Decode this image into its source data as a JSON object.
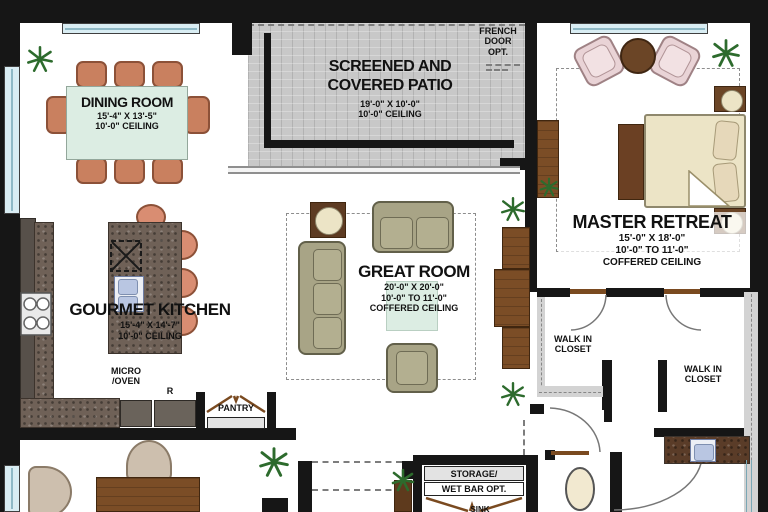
{
  "rooms": {
    "dining": {
      "title": "DINING ROOM",
      "dims": "15'-4\" X 13'-5\"",
      "ceiling": "10'-0\" CEILING"
    },
    "patio": {
      "title1": "SCREENED AND",
      "title2": "COVERED PATIO",
      "dims": "19'-0\" X 10'-0\"",
      "ceiling": "10'-0\" CEILING"
    },
    "master": {
      "title": "MASTER RETREAT",
      "dims": "15'-0\" X 18'-0\"",
      "ceiling1": "10'-0\" TO 11'-0\"",
      "ceiling2": "COFFERED CEILING"
    },
    "great": {
      "title": "GREAT ROOM",
      "dims": "20'-0\" X 20'-0\"",
      "ceiling1": "10'-0\" TO 11'-0\"",
      "ceiling2": "COFFERED CEILING"
    },
    "kitchen": {
      "title": "GOURMET KITCHEN",
      "dims": "15'-4\" X 14'-7\"",
      "ceiling": "10'-0\" CEILING"
    },
    "pantry": {
      "title": "PANTRY"
    },
    "walk_in_closet_1": {
      "line1": "WALK IN",
      "line2": "CLOSET"
    },
    "walk_in_closet_2": {
      "line1": "WALK IN",
      "line2": "CLOSET"
    },
    "storage": {
      "line1": "STORAGE/",
      "line2": "WET BAR OPT."
    }
  },
  "annotations": {
    "french_door": {
      "line1": "FRENCH",
      "line2": "DOOR",
      "line3": "OPT."
    },
    "micro_oven": {
      "line1": "MICRO",
      "line2": "/OVEN"
    },
    "refrigerator": "R",
    "sink": "SINK"
  },
  "colors": {
    "wall": "#161616",
    "floor": "#ffffff",
    "patio": "#c8c8c8",
    "granite": "#6f6157",
    "terracotta": "#c9805f",
    "olive": "#a8a486",
    "wood": "#7b4d26",
    "cream": "#ece4c6",
    "pink": "#e9d3d6",
    "mint": "#dcede3",
    "window": "#d9edf3",
    "plant": "#2d6b2d",
    "sink_blue": "#b9c6e2"
  }
}
